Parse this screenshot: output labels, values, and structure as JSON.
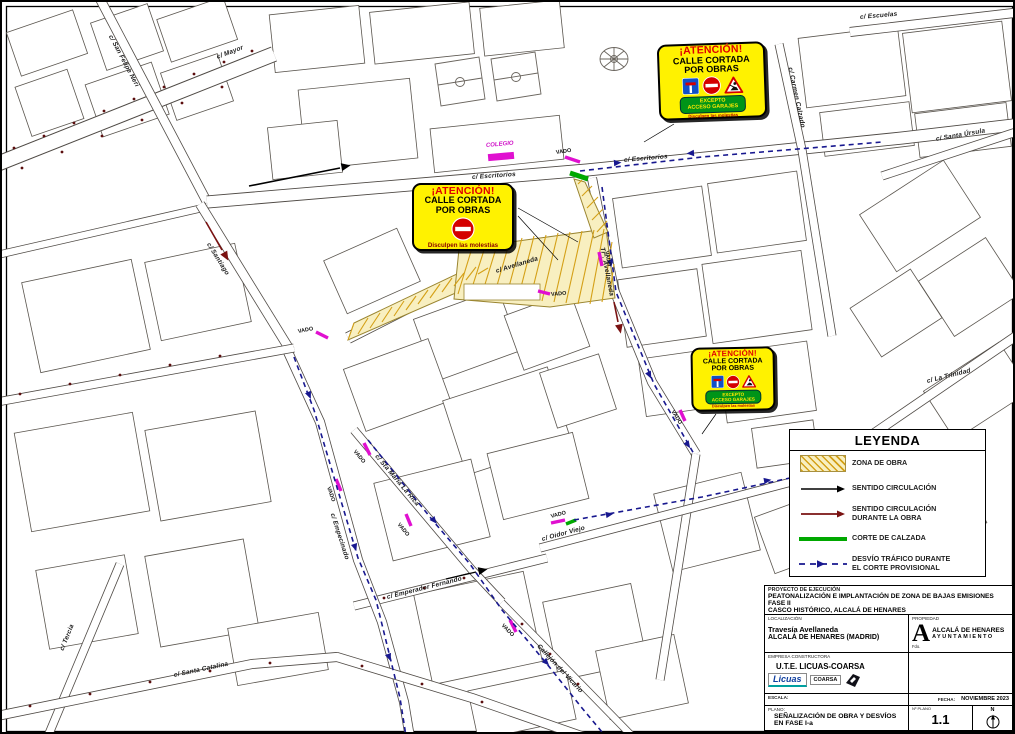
{
  "legend": {
    "title": "LEYENDA",
    "items": [
      {
        "line1": "ZONA DE OBRA"
      },
      {
        "line1": "SENTIDO CIRCULACIÓN"
      },
      {
        "line1": "SENTIDO CIRCULACIÓN",
        "line2": "DURANTE LA OBRA"
      },
      {
        "line1": "CORTE DE CALZADA"
      },
      {
        "line1": "DESVÍO TRÁFICO DURANTE",
        "line2": "EL CORTE PROVISIONAL"
      }
    ]
  },
  "signs": {
    "attention": "¡ATENCIÓN!",
    "line1": "CALLE CORTADA",
    "line2": "POR OBRAS",
    "excepto_line1": "EXCEPTO",
    "excepto_line2": "ACCESO GARAJES",
    "apology": "Disculpen las molestias"
  },
  "labels": {
    "vado": "VADO",
    "colegio": "COLEGIO"
  },
  "streets": {
    "mayor": "c/ Mayor",
    "san_felipe_neri": "c/ San Felipe Neri",
    "escritorios": "c/ Escritorios",
    "escuelas": "c/ Escuelas",
    "carmen_calzado": "c/ Carmen Calzado",
    "santa_ursula": "c/ Santa Úrsula",
    "la_trinidad": "c/ La Trinidad",
    "avellaneda": "c/ Avellaneda",
    "travesia_avellaneda": "Trª. Avellaneda",
    "santiago": "c/ Santiago",
    "empecinado": "c/ Empecinado",
    "santa_maria_la_rica": "c/ Sta María La Rica",
    "oidor_viejo": "c/ Oidor Viejo",
    "emperador_fernando": "c/ Emperador Fernando",
    "callejon_vicario": "Callejón del Vicario",
    "tercia": "c/ Tercia",
    "santa_catalina": "c/ Santa Catalina"
  },
  "titleblock": {
    "project_label": "PROYECTO DE EJECUCIÓN",
    "project_line1": "PEATONALIZACIÓN E IMPLANTACIÓN DE ZONA DE BAJAS EMISIONES FASE II",
    "project_line2": "CASCO HISTÓRICO, ALCALÁ DE HENARES",
    "location_label": "LOCALIZACIÓN",
    "location_line1": "Travesía Avellaneda",
    "location_line2": "ALCALÁ DE HENARES (MADRID)",
    "owner_label": "PROPIEDAD",
    "owner_line1": "ALCALÁ DE HENARES",
    "owner_line2": "AYUNTAMIENTO",
    "signature_label": "Fdo.",
    "contractor_label": "EMPRESA CONSTRUCTORA",
    "contractor_name": "U.T.E. LICUAS-COARSA",
    "logo_licuas": "Licuas",
    "logo_coarsa": "COARSA",
    "scale_label": "ESCALA:",
    "date_label": "FECHA:",
    "date_value": "NOVIEMBRE 2023",
    "plan_label": "PLANO:",
    "plan_line1": "SEÑALIZACIÓN DE OBRA Y DESVÍOS",
    "plan_line2": "EN FASE I-a",
    "plan_number_label": "Nº PLANO",
    "plan_number": "1.1",
    "north_label": "N"
  },
  "colors": {
    "work_zone_fill": "#F8EFC0",
    "work_zone_hatch": "#D4A017",
    "detour_blue": "#18188F",
    "corte_green": "#00A800",
    "vado_magenta": "#E010D0",
    "during_work_red": "#7A1212",
    "sign_yellow": "#FFF200",
    "sign_band_green": "#009418"
  }
}
